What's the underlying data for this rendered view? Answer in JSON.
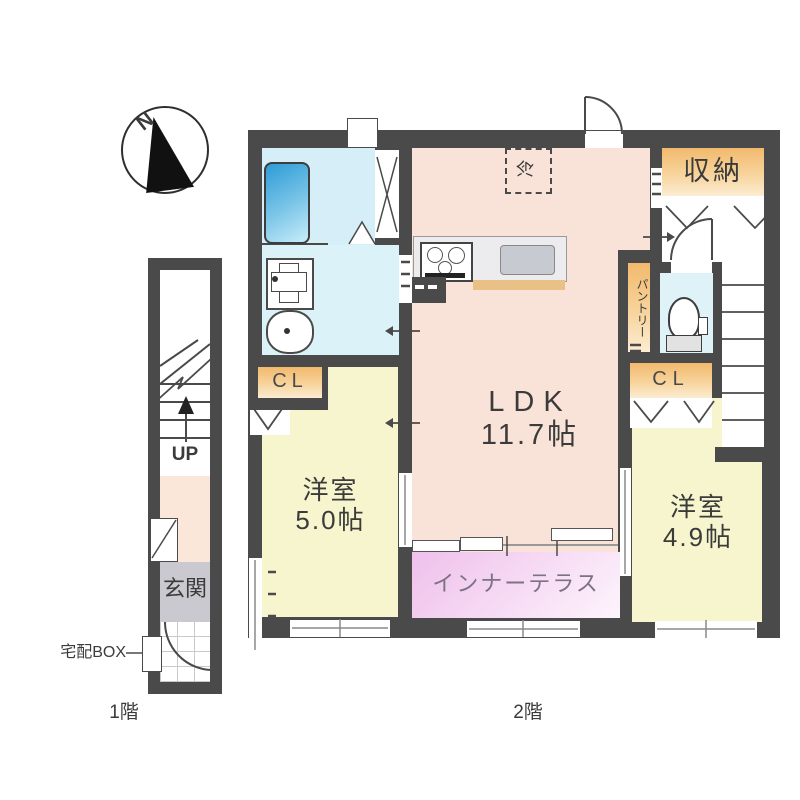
{
  "compass": {
    "north_label": "N"
  },
  "floor1": {
    "caption": "1階",
    "up_label": "UP",
    "entrance": "玄関",
    "delivery_box": "宅配BOX"
  },
  "floor2": {
    "caption": "2階",
    "ldk_name": "LDK",
    "ldk_size": "11.7帖",
    "room_left_name": "洋室",
    "room_left_size": "5.0帖",
    "room_right_name": "洋室",
    "room_right_size": "4.9帖",
    "terrace": "インナーテラス",
    "storage": "収納",
    "closet_left": "CL",
    "closet_right": "CL",
    "pantry": "パントリー",
    "refrigerator": "冷"
  },
  "colors": {
    "wall": "#4a4a4a",
    "ldk_floor": "#f9e2d8",
    "room_floor": "#f6f5cd",
    "wet_area": "#d9f0f8",
    "terrace_pink": "#efc0eb",
    "storage_accent": "#f2b96d",
    "entrance_floor": "#c9c9cf",
    "bathtub_blue": "#2d9bd6",
    "counter_edge": "#e9c086"
  }
}
